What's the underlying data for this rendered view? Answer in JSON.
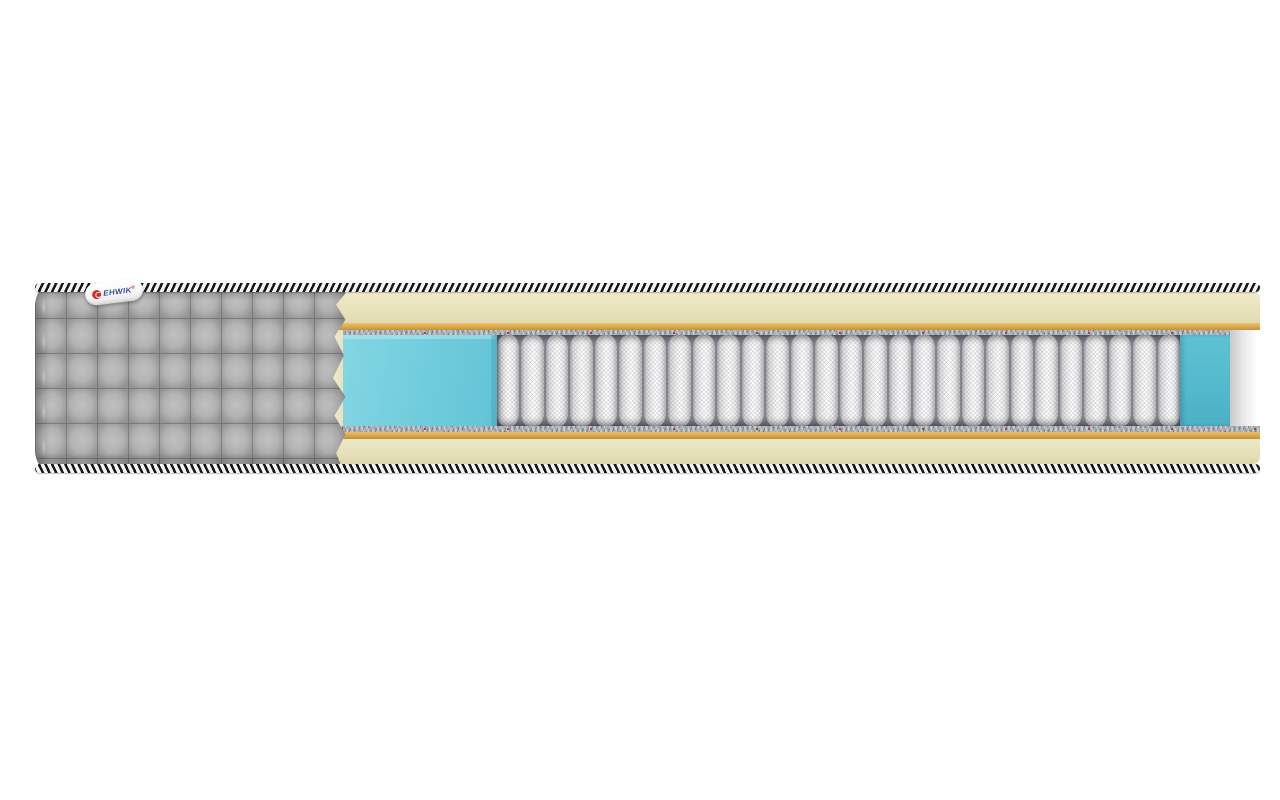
{
  "scene": {
    "description": "Cutaway 3D product render of a pocket-spring mattress on a plain white background",
    "background_color": "#ffffff"
  },
  "brand_tag": {
    "label": "EHWIK",
    "trademark_mark": "®",
    "logo": "red-circle-swirl",
    "text_color": "#2c4f9e",
    "logo_color": "#cf2a26"
  },
  "mattress": {
    "cover": {
      "name": "quilted fabric cover",
      "color": "#adadad",
      "pattern": "square quilting"
    },
    "edge_tape": {
      "name": "braided border rope",
      "color_dark": "#161616",
      "color_light": "#f4f4f4"
    },
    "layers_top_to_bottom": [
      {
        "name": "top comfort foam",
        "color": "#e9e3bd"
      },
      {
        "name": "latex adhesive layer",
        "color": "#d7a64c"
      },
      {
        "name": "felt pad",
        "color": "#a9aeb4"
      },
      {
        "name": "gel foam block / side box",
        "color": "#6fccdc"
      },
      {
        "name": "independent pocket springs",
        "color": "#f6f6f7"
      },
      {
        "name": "felt pad",
        "color": "#a9aeb4"
      },
      {
        "name": "latex adhesive layer",
        "color": "#d5a44a"
      },
      {
        "name": "bottom comfort foam",
        "color": "#e7e1ba"
      }
    ],
    "springs": {
      "count": 28
    }
  }
}
